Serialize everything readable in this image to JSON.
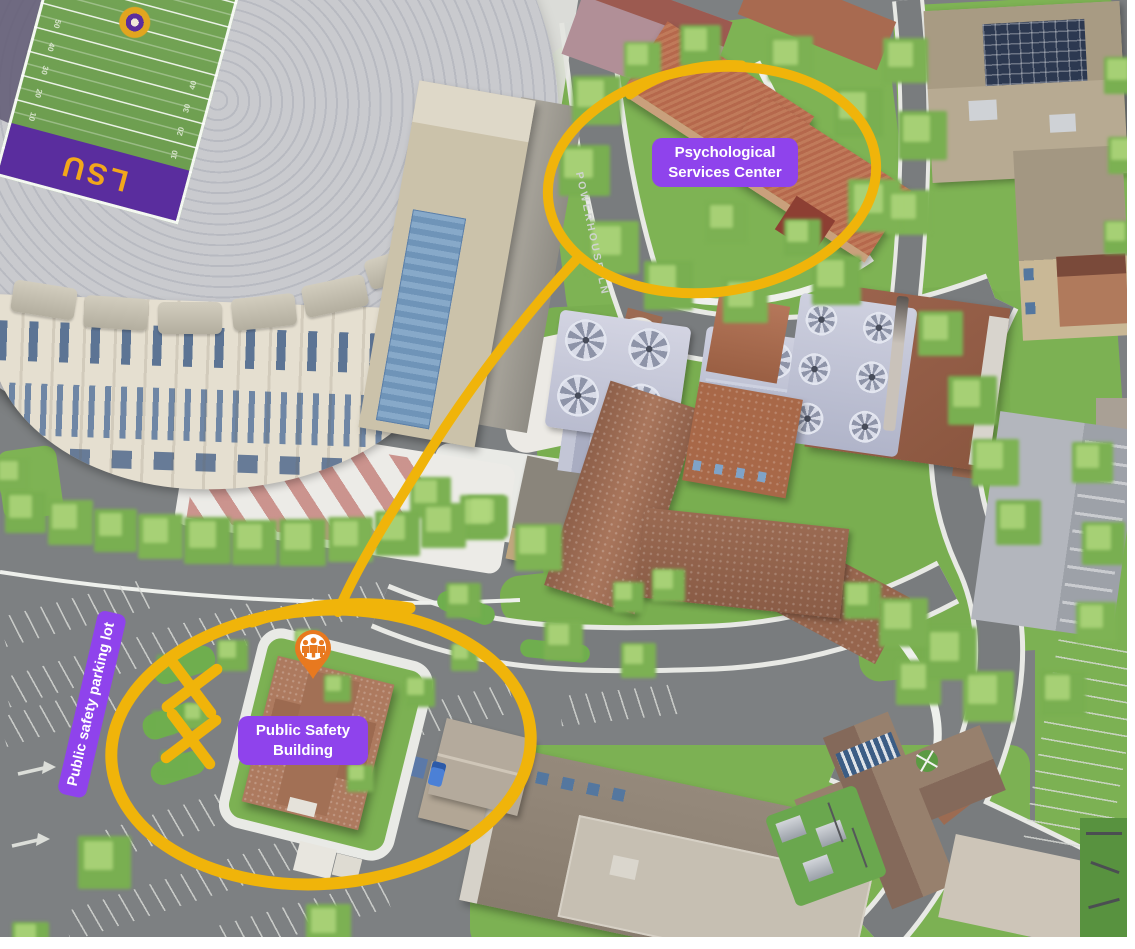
{
  "annotations": {
    "highlight_color": "#F0B40A",
    "label_bg": "#8F43EC",
    "label_fg": "#FFFFFF",
    "psych_label": {
      "line1": "Psychological",
      "line2": "Services Center"
    },
    "safety_label": {
      "line1": "Public Safety",
      "line2": "Building"
    },
    "parking_label": "Public safety parking lot",
    "x_mark_count": 2,
    "pin": {
      "shape": "map-pin",
      "color": "#E8791F",
      "glyph": "people-group"
    }
  },
  "streets": {
    "powerhouse_lane": "POWERHOUSE LN"
  },
  "stadium": {
    "endzone_text": "LSU",
    "endzone_color": "#5A2D9E",
    "endzone_text_color": "#F2A71B",
    "yard_numbers": [
      "50",
      "40",
      "30",
      "20",
      "10"
    ]
  }
}
